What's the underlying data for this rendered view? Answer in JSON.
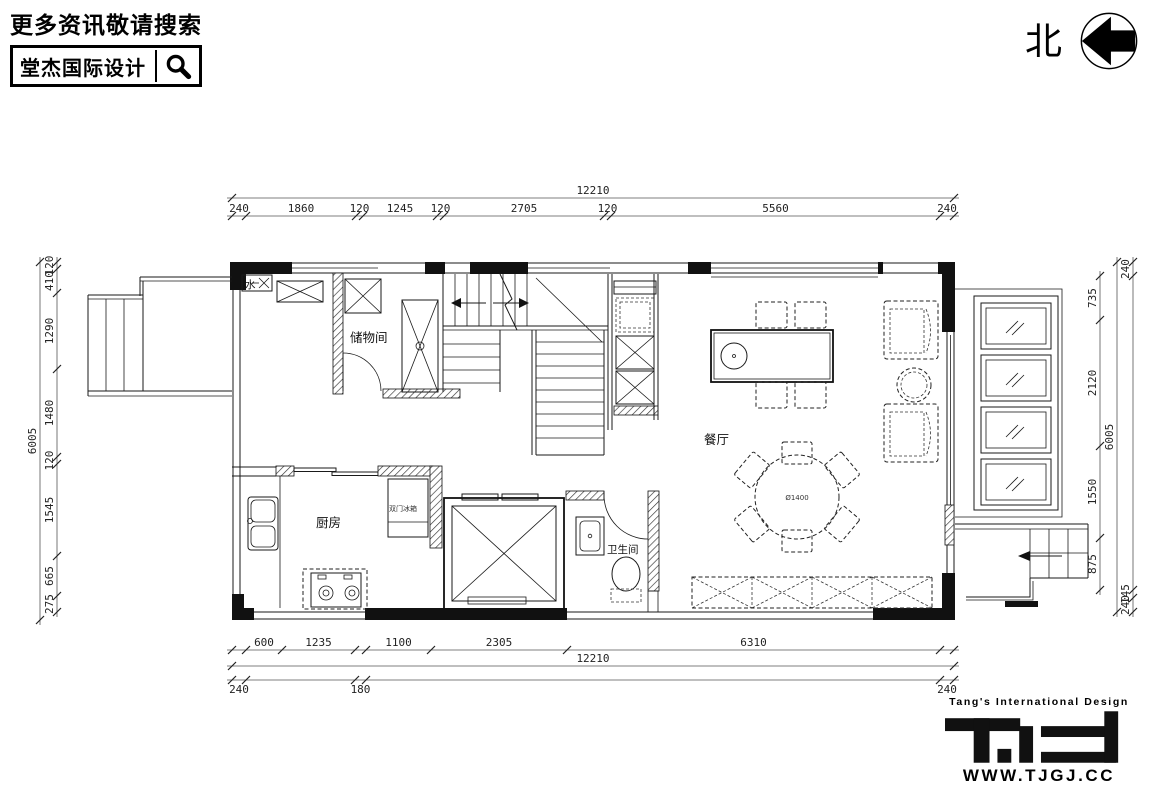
{
  "header": {
    "search_prompt": "更多资讯敬请搜索",
    "brand_name": "堂杰国际设计",
    "icons": {
      "search": "magnifier"
    }
  },
  "compass": {
    "north_label": "北",
    "icon": "arrow-left-in-circle"
  },
  "plan": {
    "rooms": [
      {
        "label": "储物间"
      },
      {
        "label": "厨房"
      },
      {
        "label": "卫生间"
      },
      {
        "label": "餐厅"
      }
    ],
    "annotations": [
      {
        "label": "水"
      },
      {
        "label": "双门冰箱"
      },
      {
        "label": "Ø1400"
      }
    ],
    "dimensions": {
      "top": {
        "overall": "12210",
        "chain": [
          "240",
          "1860",
          "120",
          "1245",
          "120",
          "2705",
          "120",
          "5560",
          "240"
        ]
      },
      "bottom": {
        "overall": "12210",
        "chain": [
          "600",
          "1235",
          "1100",
          "2305",
          "6310"
        ],
        "outer": [
          "240",
          "180",
          "240"
        ]
      },
      "left": {
        "overall": "6005",
        "chain": [
          "120",
          "410",
          "1290",
          "1480",
          "120",
          "1545",
          "665",
          "275"
        ]
      },
      "right": {
        "overall": "6005",
        "chain": [
          "735",
          "2120",
          "1550",
          "875"
        ],
        "outer": [
          "240",
          "145",
          "240"
        ]
      }
    }
  },
  "footer": {
    "tagline": "Tang's International Design",
    "logo": "T·id",
    "website": "WWW.TJGJ.CC"
  }
}
